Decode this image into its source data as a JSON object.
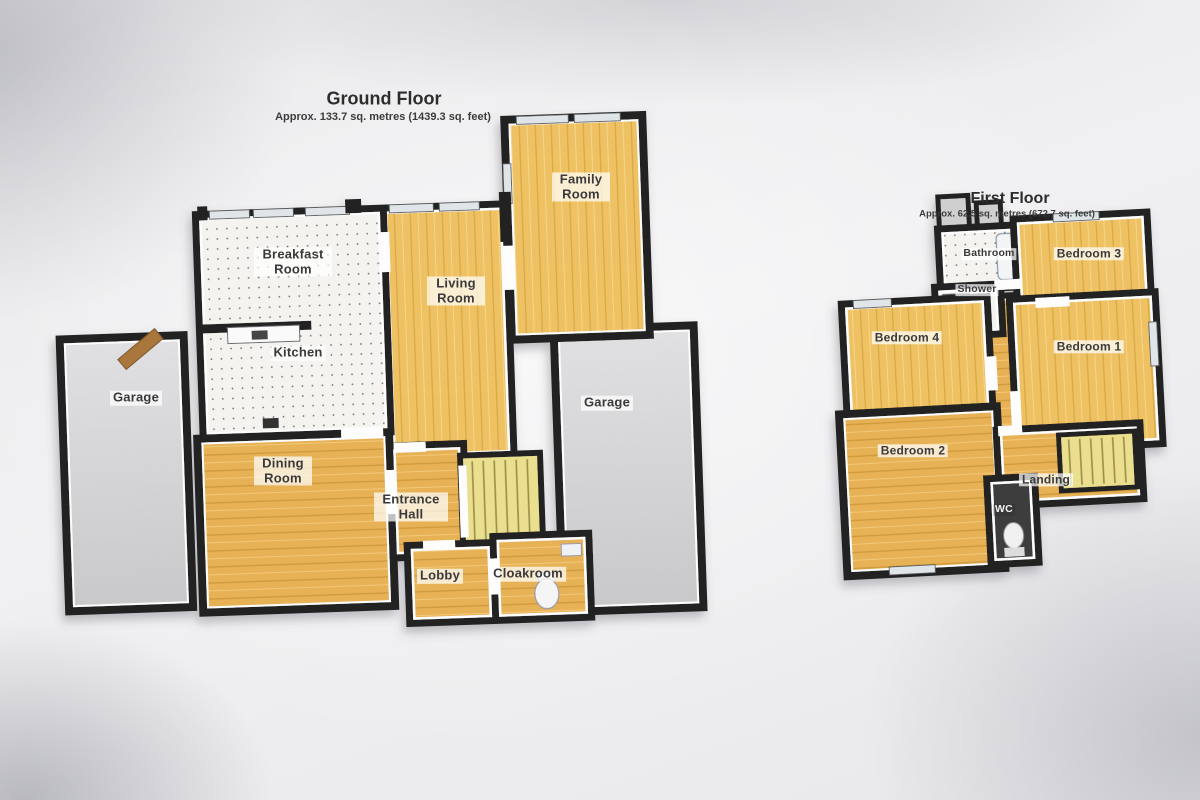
{
  "ground_floor": {
    "title": "Ground Floor",
    "subtitle": "Approx. 133.7 sq. metres (1439.3 sq. feet)",
    "rooms": {
      "breakfast_room": "Breakfast Room",
      "kitchen": "Kitchen",
      "living_room": "Living Room",
      "family_room": "Family Room",
      "garage_left": "Garage",
      "garage_right": "Garage",
      "dining_room": "Dining Room",
      "entrance_hall": "Entrance Hall",
      "lobby": "Lobby",
      "cloakroom": "Cloakroom"
    }
  },
  "first_floor": {
    "title": "First Floor",
    "subtitle": "Approx. 62.5 sq. metres (672.7 sq. feet)",
    "rooms": {
      "bathroom": "Bathroom",
      "shower": "Shower",
      "bedroom_1": "Bedroom 1",
      "bedroom_2": "Bedroom 2",
      "bedroom_3": "Bedroom 3",
      "bedroom_4": "Bedroom 4",
      "landing": "Landing",
      "wc": "WC"
    }
  },
  "colors": {
    "wall": "#232323",
    "wood_light": "#eec263",
    "wood_deep": "#e7b254",
    "tile": "#f4f3f0",
    "garage_floor": "#d4d4d6",
    "stairs": "#eadf8e",
    "paper": "#ebebed"
  }
}
